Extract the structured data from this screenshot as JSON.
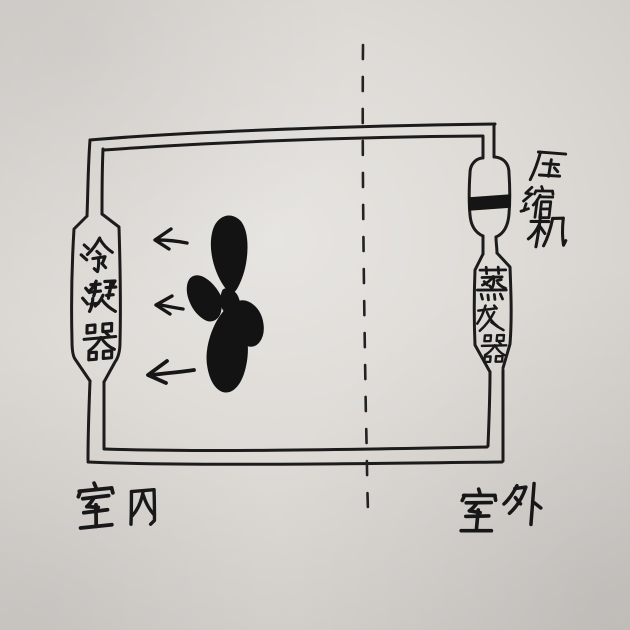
{
  "diagram": {
    "components": {
      "condenser": {
        "label": "冷凝器"
      },
      "compressor": {
        "label": "压缩机"
      },
      "evaporator": {
        "label": "蒸发器"
      }
    },
    "zones": {
      "indoor": {
        "label": "室内"
      },
      "outdoor": {
        "label": "室外"
      }
    },
    "fan": {
      "blade_count": 4
    },
    "airflow": {
      "arrow_count": 3,
      "direction": "left"
    },
    "divider": {
      "style": "dashed",
      "orientation": "vertical"
    },
    "colors": {
      "ink": "#1a1a1a",
      "paper": "#dbd8d4"
    }
  }
}
